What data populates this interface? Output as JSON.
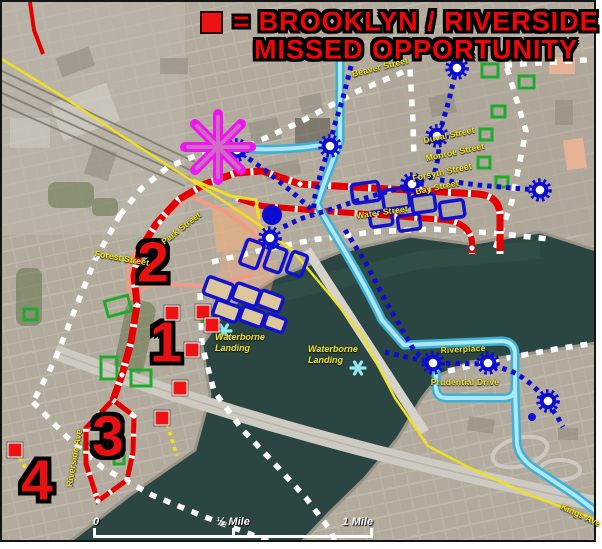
{
  "title": {
    "line1": "= BROOKLYN / RIVERSIDE",
    "line2": "MISSED OPPORTUNITY"
  },
  "legend": {
    "marker": "red-square",
    "marker_color": "#ee1212"
  },
  "area_markers": [
    {
      "label": "1",
      "x": 166,
      "y": 343
    },
    {
      "label": "2",
      "x": 153,
      "y": 263
    },
    {
      "label": "3",
      "x": 108,
      "y": 437
    },
    {
      "label": "4",
      "x": 37,
      "y": 481
    }
  ],
  "missed_opportunity_markers": [
    {
      "x": 172,
      "y": 313
    },
    {
      "x": 203,
      "y": 312
    },
    {
      "x": 212,
      "y": 325
    },
    {
      "x": 192,
      "y": 350
    },
    {
      "x": 180,
      "y": 388
    },
    {
      "x": 162,
      "y": 418
    },
    {
      "x": 15,
      "y": 450
    }
  ],
  "street_labels": [
    {
      "text": "Beaver Street",
      "x": 380,
      "y": 67,
      "rot": -14
    },
    {
      "text": "Duval Street",
      "x": 449,
      "y": 135,
      "rot": -12
    },
    {
      "text": "Monroe Street",
      "x": 455,
      "y": 152,
      "rot": -12
    },
    {
      "text": "Forsyth Street",
      "x": 442,
      "y": 172,
      "rot": -12
    },
    {
      "text": "Bay Street",
      "x": 437,
      "y": 187,
      "rot": -12
    },
    {
      "text": "Water Street",
      "x": 382,
      "y": 212,
      "rot": -8
    },
    {
      "text": "Park Street",
      "x": 181,
      "y": 228,
      "rot": -38
    },
    {
      "text": "Forest Street",
      "x": 122,
      "y": 258,
      "rot": 10
    },
    {
      "text": "Riverside Ave",
      "x": 74,
      "y": 458,
      "rot": -80
    },
    {
      "text": "Riverplace",
      "x": 463,
      "y": 349,
      "rot": -3
    },
    {
      "text": "Prudential Drive",
      "x": 465,
      "y": 382,
      "rot": 0
    },
    {
      "text": "Kings Ave",
      "x": 581,
      "y": 515,
      "rot": 25
    }
  ],
  "poi_labels": [
    {
      "text": "Waterborne Landing",
      "x": 247,
      "y": 343
    },
    {
      "text": "Waterborne Landing",
      "x": 340,
      "y": 355
    }
  ],
  "scale_bar": {
    "start_label": "0",
    "mid_label": "½ Mile",
    "end_label": "1 Mile"
  },
  "transit_stations": [
    [
      237,
      150
    ],
    [
      330,
      146
    ],
    [
      412,
      184
    ],
    [
      437,
      136
    ],
    [
      457,
      68
    ],
    [
      540,
      190
    ],
    [
      270,
      238
    ],
    [
      433,
      363
    ],
    [
      488,
      363
    ],
    [
      548,
      401
    ]
  ],
  "colors": {
    "missed_opportunity_red": "#ee1212",
    "route_red": "#e40000",
    "route_blue": "#0c0cd2",
    "skyway_cyan": "#5fc6e2",
    "boundary_white": "#ffffff",
    "highlight_magenta": "#ee16ee",
    "label_yellow": "#f6e81e",
    "park_green": "#1faa2e",
    "water": "#2b4642"
  }
}
